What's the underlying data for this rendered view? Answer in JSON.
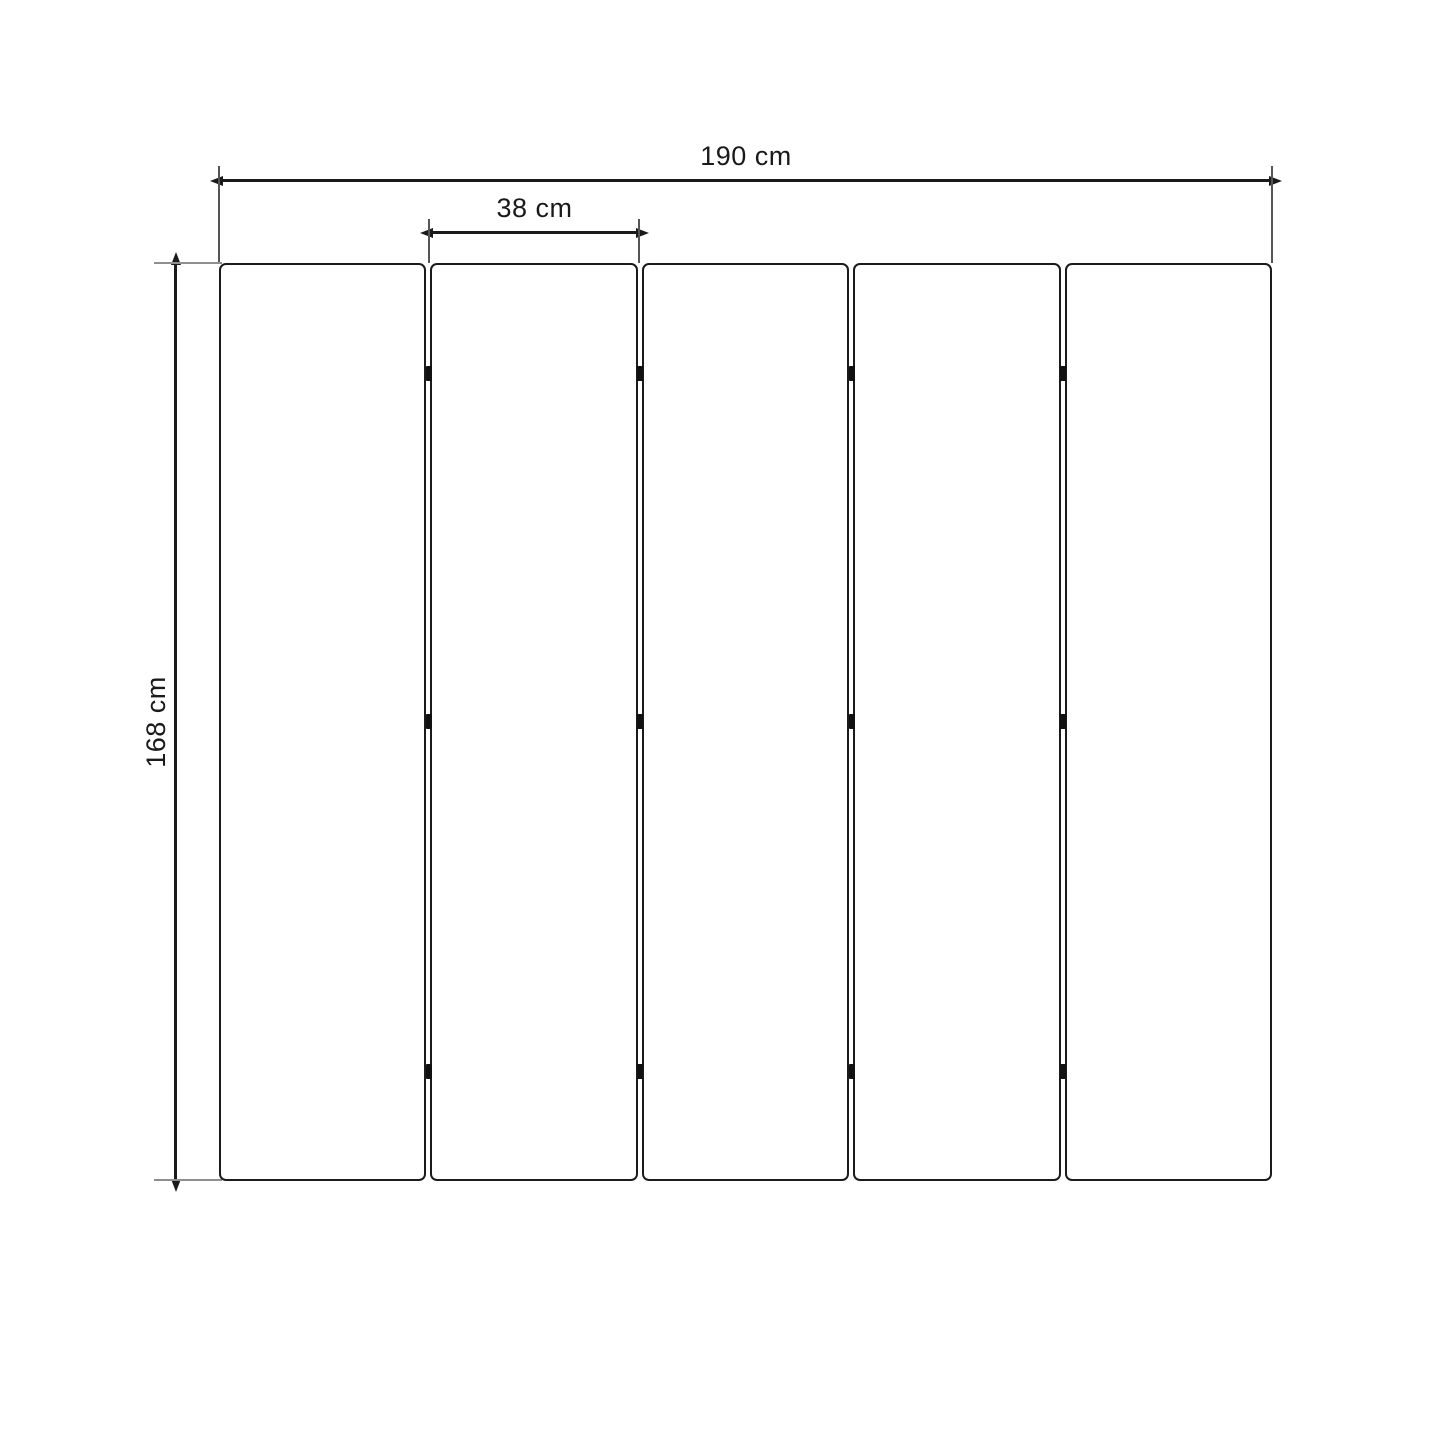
{
  "diagram": {
    "type": "dimension-drawing",
    "subject": "folding-screen-five-panels",
    "panel_count": 5,
    "labels": {
      "total_width": "190 cm",
      "slat_width": "38 cm",
      "height": "168 cm"
    },
    "values": {
      "total_width_cm": 190,
      "slat_width_cm": 38,
      "height_cm": 168
    },
    "colors": {
      "background": "#ffffff",
      "dimension_line": "#1a1a1a",
      "extension_line": "#555555",
      "tick_line": "#8f8f8f",
      "panel_border": "#1b1b1b",
      "hinge": "#111111"
    }
  }
}
